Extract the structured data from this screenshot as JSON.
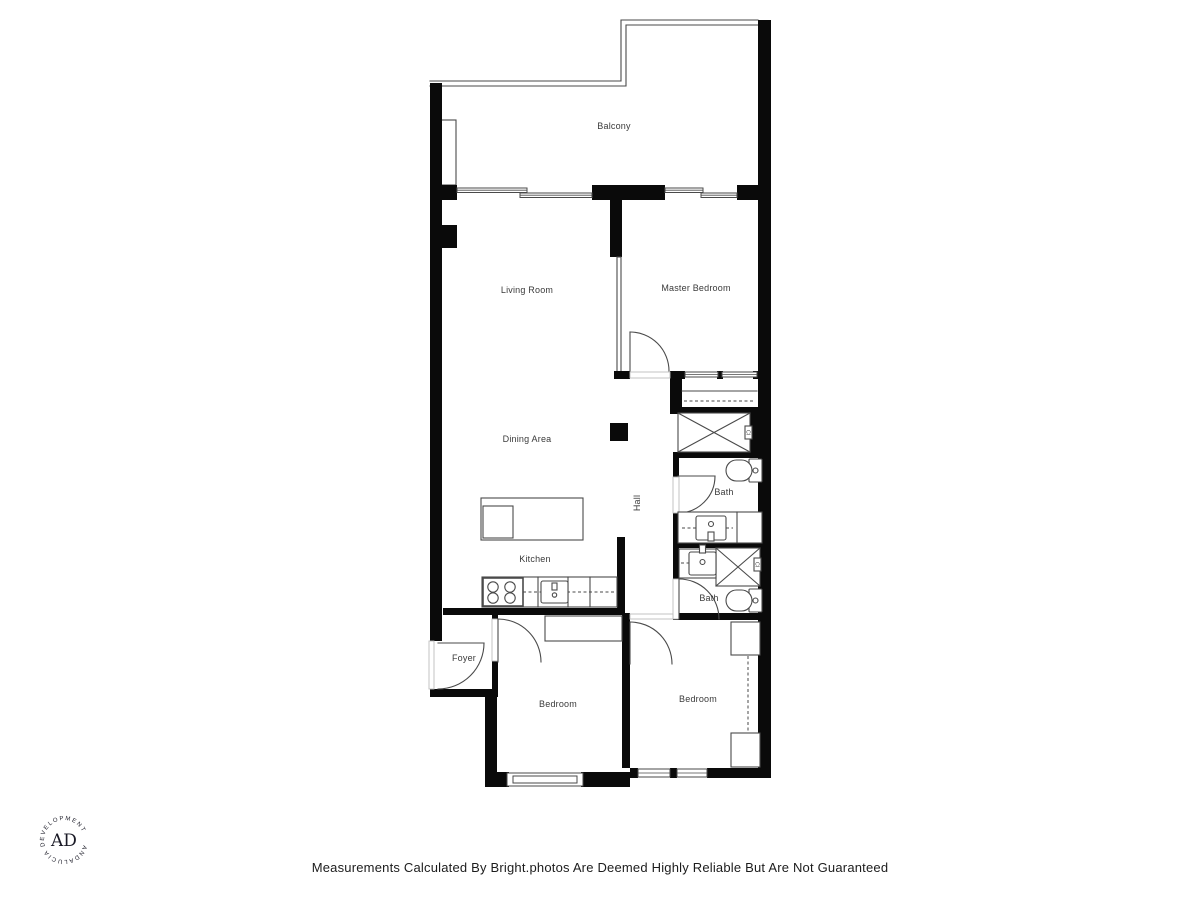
{
  "colors": {
    "background": "#ffffff",
    "wall": "#0a0a0a",
    "line": "#4a4a4a",
    "label": "#3a3a3a",
    "jamb": "#bdbdbd",
    "logo": "#1a1a26",
    "footer_text": "#1c1c1c"
  },
  "floor_plan": {
    "rooms": {
      "balcony": "Balcony",
      "living_room": "Living Room",
      "master_bedroom": "Master Bedroom",
      "dining_area": "Dining Area",
      "hall": "Hall",
      "bath_upper": "Bath",
      "bath_lower": "Bath",
      "kitchen": "Kitchen",
      "foyer": "Foyer",
      "bedroom_left": "Bedroom",
      "bedroom_right": "Bedroom",
      "closet_upper": "Cl",
      "closet_lower": "Cl"
    }
  },
  "branding": {
    "monogram": "AD",
    "ring_text": "ANDALUCIA  DEVELOPMENT "
  },
  "footer": {
    "disclaimer": "Measurements Calculated By Bright.photos Are Deemed Highly Reliable But Are Not Guaranteed"
  }
}
